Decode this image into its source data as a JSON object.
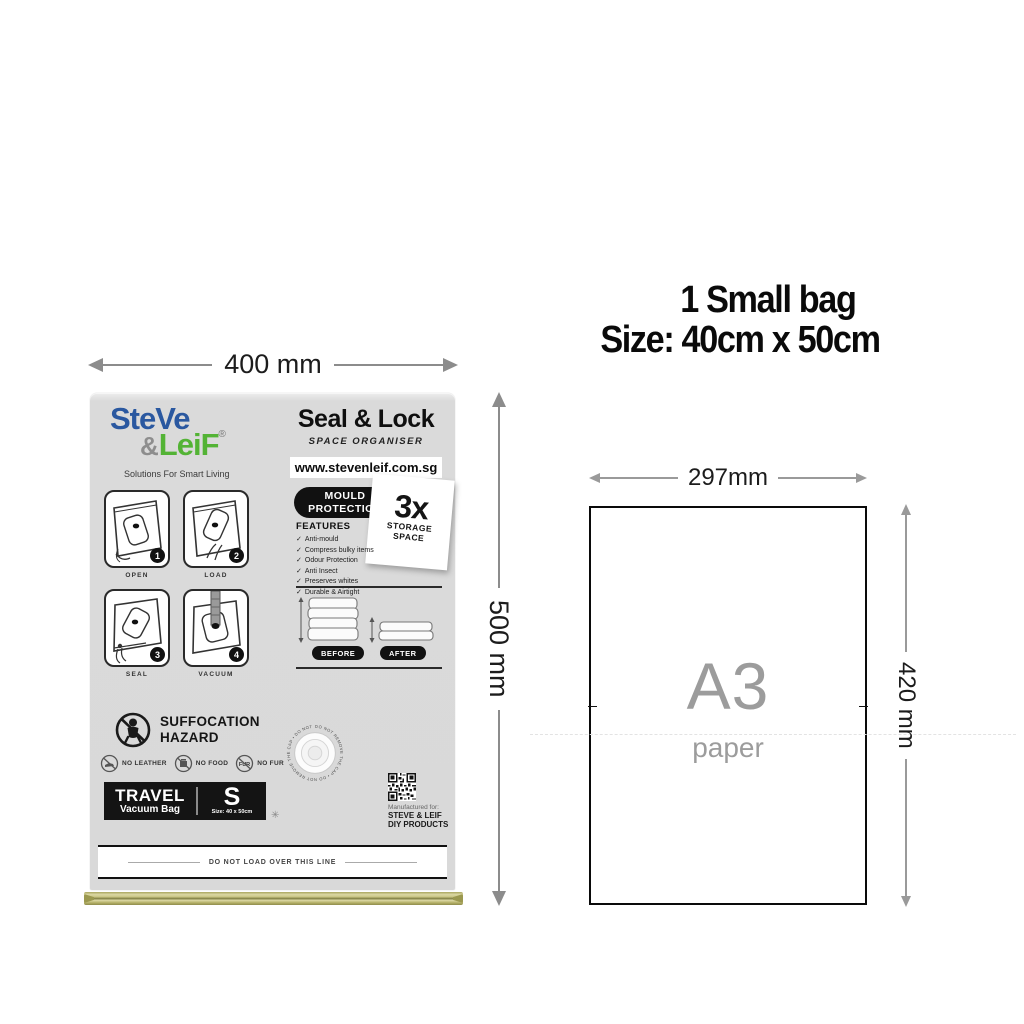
{
  "left_figure": {
    "width_label": "400 mm",
    "height_label": "500 mm",
    "bag": {
      "brand": {
        "name_line1": "SteVe",
        "amp": "&",
        "name_line2": "LeiF",
        "reg": "®",
        "tagline": "Solutions For Smart Living"
      },
      "header": {
        "title": "Seal & Lock",
        "subtitle": "SPACE ORGANISER",
        "website": "www.stevenleif.com.sg"
      },
      "steps": [
        {
          "num": "1",
          "label": "OPEN"
        },
        {
          "num": "2",
          "label": "LOAD"
        },
        {
          "num": "3",
          "label": "SEAL"
        },
        {
          "num": "4",
          "label": "VACUUM"
        }
      ],
      "mould": {
        "line1": "MOULD",
        "line2": "PROTECTION"
      },
      "storage_badge": {
        "value": "3x",
        "line1": "STORAGE",
        "line2": "SPACE"
      },
      "features": {
        "heading": "FEATURES",
        "check": "✓",
        "items": [
          "Anti-mould",
          "Compress bulky items",
          "Odour Protection",
          "Anti Insect",
          "Preserves whites",
          "Durable & Airtight"
        ]
      },
      "comparison": {
        "before": "BEFORE",
        "after": "AFTER"
      },
      "hazard": {
        "line1": "SUFFOCATION",
        "line2": "HAZARD"
      },
      "prohibitions": [
        {
          "label": "NO LEATHER"
        },
        {
          "label": "NO FOOD"
        },
        {
          "label": "NO FUR",
          "icon_text": "FUR"
        }
      ],
      "size_bar": {
        "type": "TRAVEL",
        "product": "Vacuum Bag",
        "size_letter": "S",
        "size_text": "Size: 40 x 50cm"
      },
      "valve_ring_text": "DO NOT REMOVE THE CAP • DO NOT REMOVE THE CAP • DO NOT REMOVE THE CAP •",
      "manufactured": {
        "line1": "Manufactured for:",
        "line2": "STEVE & LEIF",
        "line3": "DIY PRODUCTS"
      },
      "load_line": "DO NOT LOAD OVER THIS LINE",
      "snowflake": "✳"
    }
  },
  "right_figure": {
    "title_line1": "1 Small bag",
    "title_line2": "Size: 40cm x 50cm",
    "paper": {
      "width_label": "297mm",
      "height_label": "420 mm",
      "name": "A3",
      "type": "paper"
    }
  },
  "colors": {
    "brand_blue": "#2a58a0",
    "brand_green": "#53b335",
    "bag_gray": "#d9d9d9",
    "zipper_olive": "#b5b169",
    "arrow_gray": "#8c8c8c",
    "black": "#111111"
  }
}
